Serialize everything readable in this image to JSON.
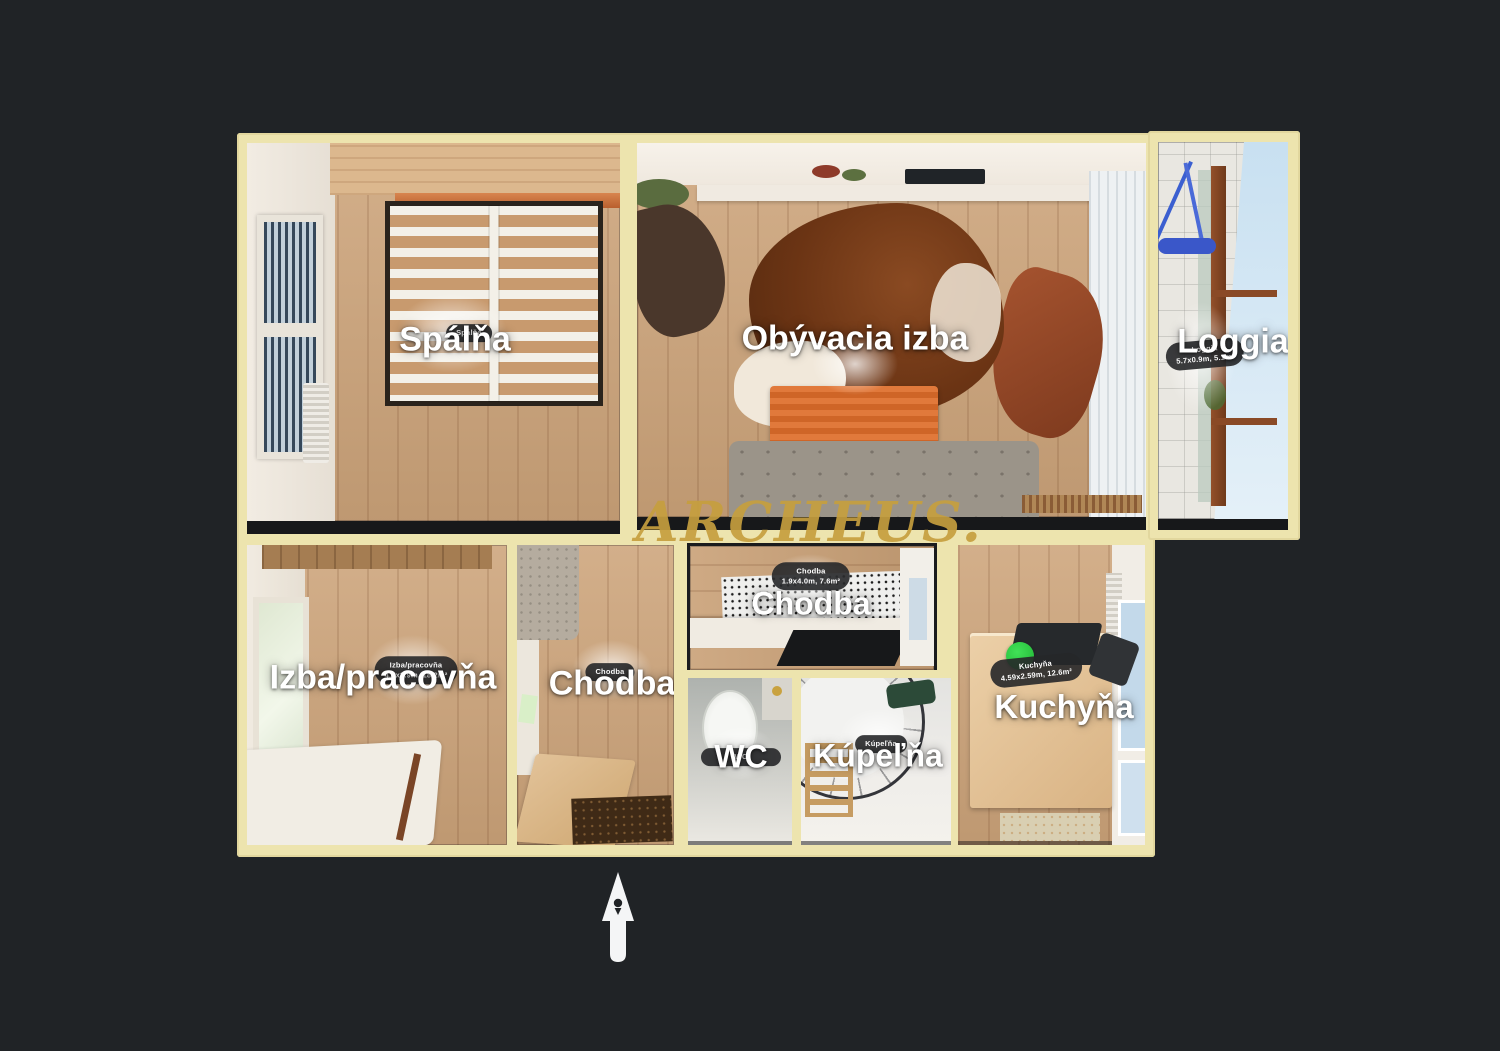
{
  "watermark": {
    "text": "ARCHEUS."
  },
  "icons": {
    "north_arrow": "north-arrow"
  },
  "colors": {
    "background": "#202326",
    "walls": "#EDE4AE",
    "label_text": "#FFFFFF",
    "badge_background": "#262729",
    "watermark_gold": "#C59E3E",
    "start_point_green": "#27CE3D",
    "north_arrow_white": "#F4F5F6"
  },
  "rooms": {
    "spalna": {
      "label": "Spálňa",
      "badge1": "Spálňa"
    },
    "obyvacia_izba": {
      "label": "Obývacia izba"
    },
    "loggia": {
      "label": "Loggia",
      "badge1": "Loggia",
      "badge2": "5.7x0.9m, 5.1m²"
    },
    "izba_pracovna": {
      "label": "Izba/pracovňa",
      "badge1": "Izba/pracovňa",
      "badge2": "4.7x3.9m, 18.2m²"
    },
    "chodba_main": {
      "label": "Chodba",
      "badge1": "Chodba"
    },
    "chodba_top": {
      "label": "Chodba",
      "badge1": "Chodba",
      "badge2": "1.9x4.0m, 7.6m²"
    },
    "wc": {
      "label": "WC",
      "badge1": "WC"
    },
    "kupelna": {
      "label": "Kúpeľňa",
      "badge1": "Kúpeľňa"
    },
    "kuchyna": {
      "label": "Kuchyňa",
      "badge1": "Kuchyňa",
      "badge2": "4.59x2.59m, 12.6m²"
    }
  }
}
